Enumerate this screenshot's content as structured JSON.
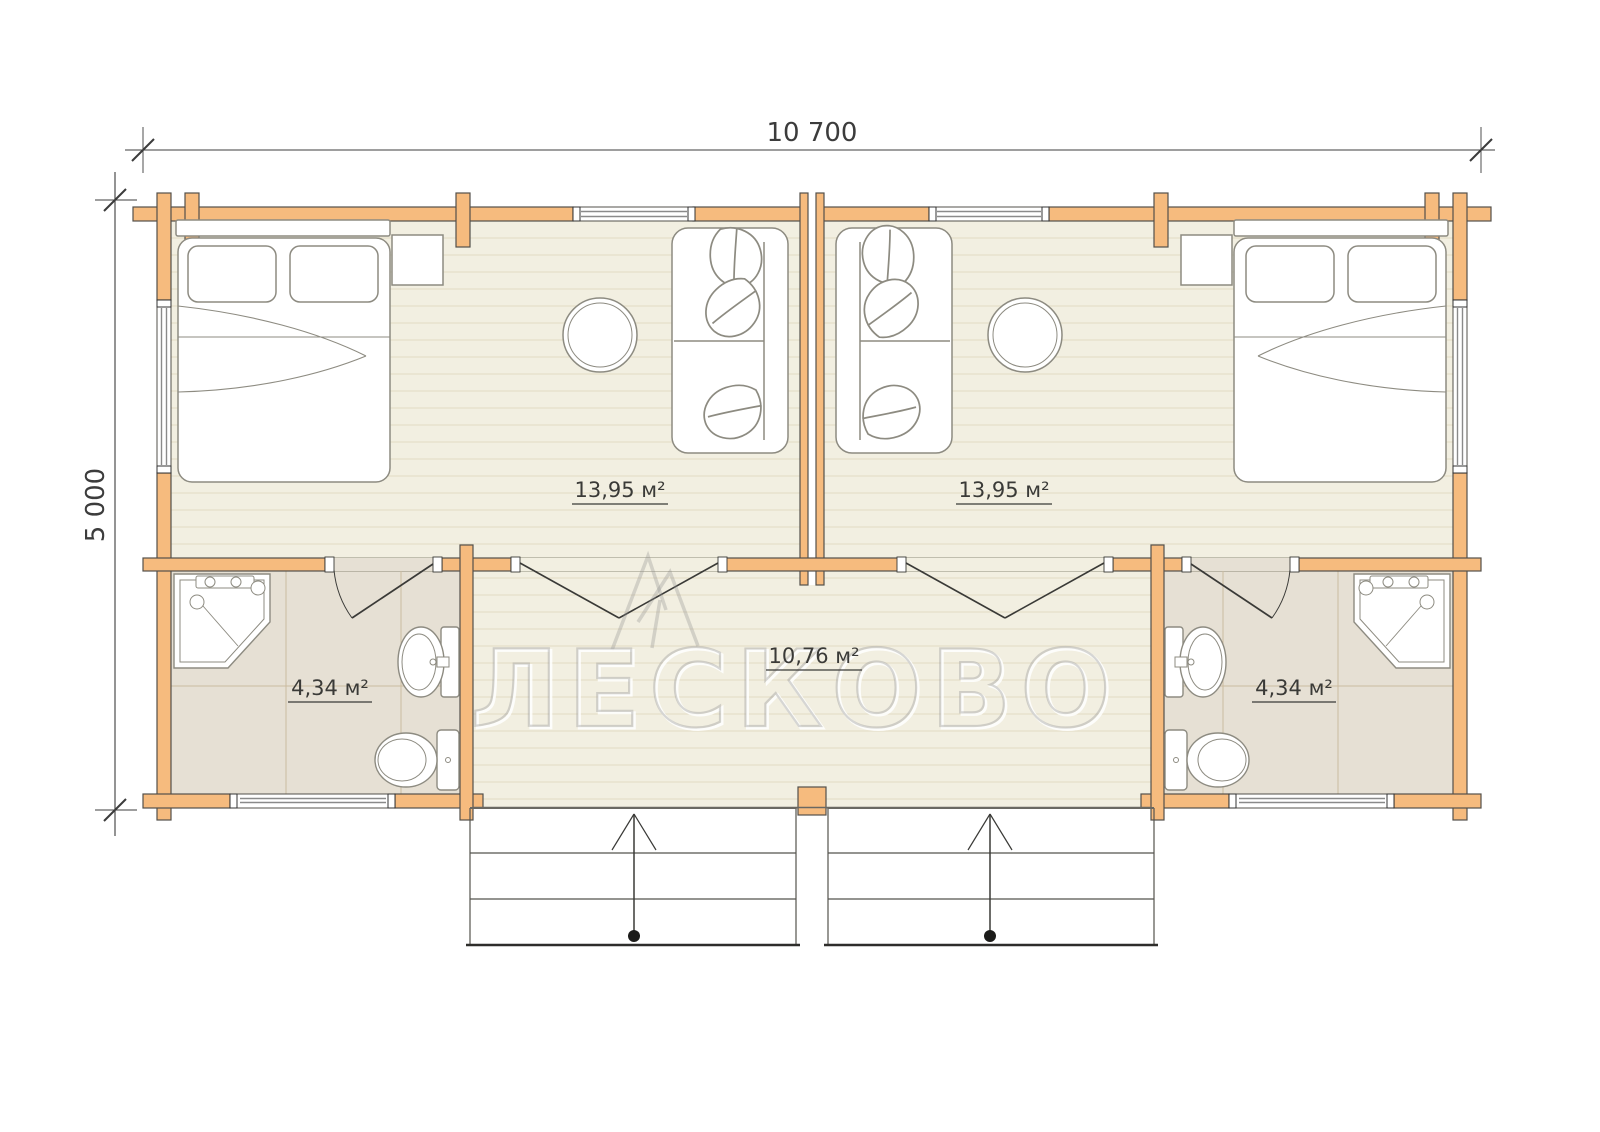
{
  "drawing": {
    "top_dimension": "10 700",
    "left_dimension": "5 000"
  },
  "rooms": {
    "living_left": {
      "area_label": "13,95 м²"
    },
    "living_right": {
      "area_label": "13,95 м²"
    },
    "bathroom_left": {
      "area_label": "4,34 м²"
    },
    "bathroom_right": {
      "area_label": "4,34 м²"
    },
    "hall": {
      "area_label": "10,76 м²"
    }
  },
  "watermark": {
    "text": "ЛЕСКОВО"
  },
  "colors": {
    "wall_fill": "#f6bb7e",
    "wall_stroke": "#53504b",
    "floor_main": "#f2efe1",
    "plank_line": "#e3dbc2",
    "floor_bath": "#e6e0d4",
    "tile_line": "#cbbb9f",
    "ink": "#3a3a37",
    "furniture_stroke": "#8d8b81",
    "dim_ink": "#3c3c3c",
    "watermark_gray": "#9c9c9c"
  }
}
